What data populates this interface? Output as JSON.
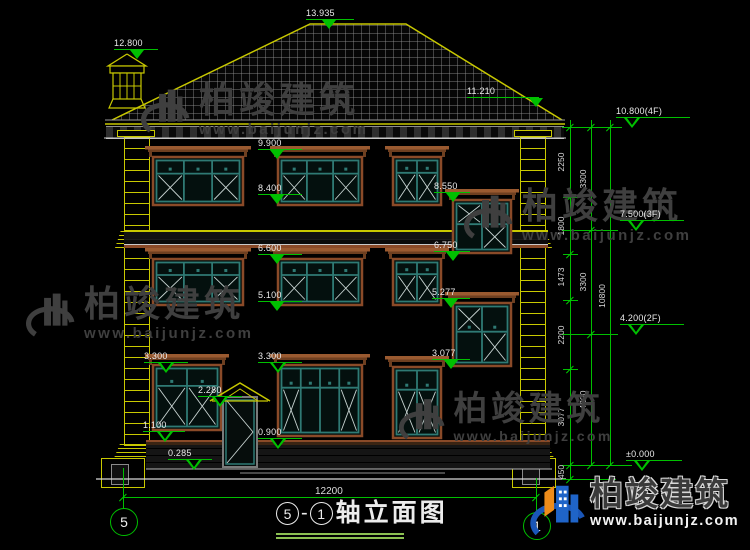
{
  "title_bar": {
    "axis_start": "5",
    "separator": "-",
    "axis_end": "1",
    "title": "轴立面图"
  },
  "bottom_dim": "12200",
  "levels": {
    "ridge": "13.935",
    "chimney": "12.800",
    "eave": "11.210",
    "floor4": "10.800(4F)",
    "floor3": "7.500(3F)",
    "floor2": "4.200(2F)",
    "ground": "±0.000",
    "w4_top": "9.900",
    "w4_bottom": "8.400",
    "stair1_top": "8.550",
    "stair1_bottom": "6.750",
    "w3_top": "6.600",
    "w3_bottom": "5.100",
    "stair2_top": "5.277",
    "stair2_bottom": "3.077",
    "w1_top_left": "3.300",
    "w1_top_mid": "3.300",
    "door_top": "2.280",
    "w1_bottom_left": "1.100",
    "w1_bottom_mid": "0.900",
    "porch": "0.285"
  },
  "dim_chains": {
    "inner": [
      "2250",
      "1800",
      "1473",
      "2200",
      "3077",
      "450"
    ],
    "middle": [
      "3300",
      "3300",
      "4200"
    ],
    "outer": [
      "10800"
    ]
  },
  "watermarks": {
    "company": "柏竣建筑",
    "website": "www.baijunjz.com"
  },
  "brand_logo": {
    "company": "柏竣建筑",
    "website": "www.baijunjz.com"
  }
}
